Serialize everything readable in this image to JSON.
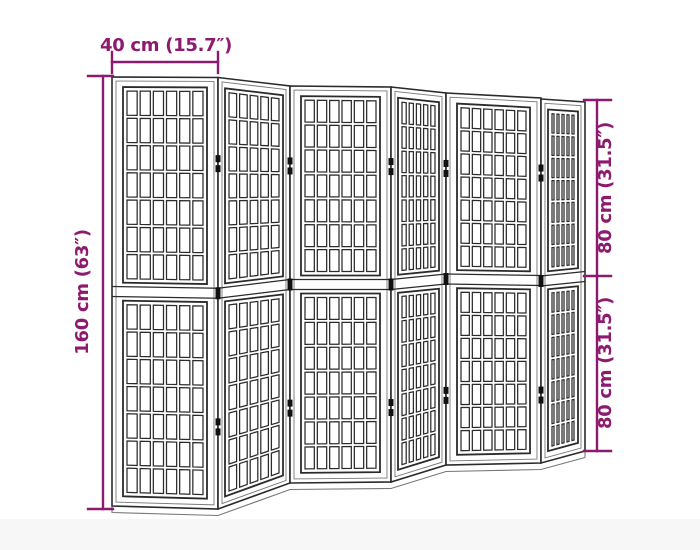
{
  "figure": {
    "alt": "6-panel folding room divider, line drawing with dimension arrows",
    "panel_count": 6,
    "sections_per_panel": 2,
    "grid_rows_per_section": 7,
    "grid_cols_front_panel": 6,
    "grid_cols_angled_panel": 5
  },
  "dimensions": {
    "width_label": "40 cm (15.7″)",
    "height_label": "160 cm (63″)",
    "upper_half_label": "80 cm (31.5″)",
    "lower_half_label": "80 cm (31.5″)"
  },
  "colors": {
    "accent": "#8E1A6F",
    "line": "#2b2b2b",
    "line_soft": "#777777",
    "hinge": "#111111",
    "background": "#ffffff",
    "floor_band": "#f7f7f7"
  }
}
